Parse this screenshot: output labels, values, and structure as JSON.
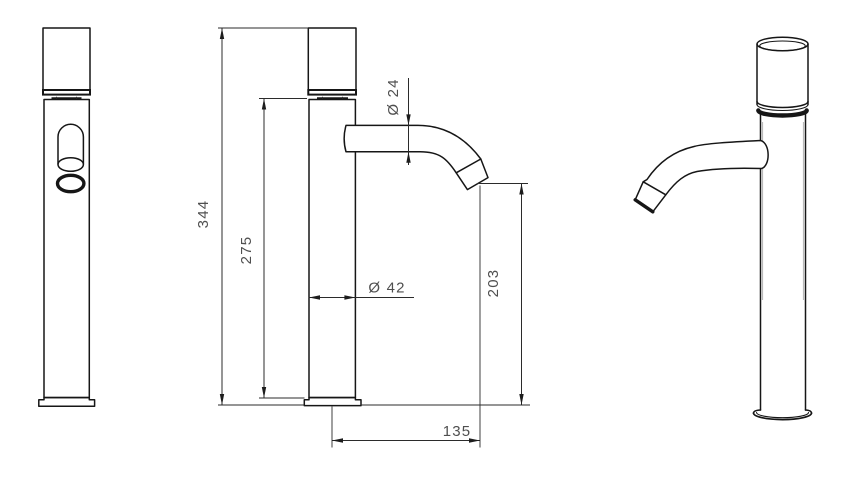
{
  "drawing": {
    "dimensions": {
      "overall_height": "344",
      "upper_body_height": "275",
      "spout_tube_diameter": "Ø 24",
      "body_diameter": "Ø 42",
      "spout_outlet_height": "203",
      "spout_reach": "135"
    },
    "colors": {
      "background": "#ffffff",
      "outline": "#161616",
      "dimension_line": "#2b2b2b",
      "dimension_text": "#4f4f4f"
    }
  }
}
